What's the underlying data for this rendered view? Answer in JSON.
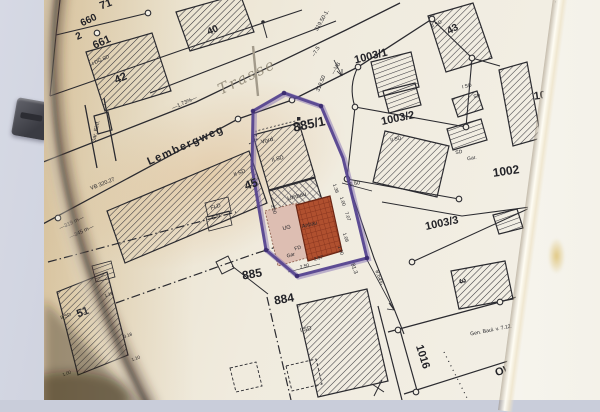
{
  "map": {
    "accent_colors": {
      "annotation_purple": "#53418e",
      "anbau_red": "#b0502f",
      "anbau_pink": "#ddbeb2",
      "paper_tan": "#e9dcc0",
      "pencil_grey": "#98907e"
    },
    "labels": [
      {
        "name": "parcel-label-71",
        "text": "71",
        "x": 106,
        "y": 5,
        "rot": -20,
        "size": 11,
        "w": 700
      },
      {
        "name": "parcel-label-660",
        "text": "660",
        "x": 89,
        "y": 21,
        "rot": -25,
        "size": 10,
        "w": 700
      },
      {
        "name": "parcel-label-660-denominator",
        "text": "2",
        "x": 79,
        "y": 37,
        "rot": -25,
        "size": 10,
        "w": 700
      },
      {
        "name": "parcel-label-661",
        "text": "661",
        "x": 102,
        "y": 43,
        "rot": -24,
        "size": 11,
        "w": 700
      },
      {
        "name": "building-label-42",
        "text": "42",
        "x": 121,
        "y": 79,
        "rot": -24,
        "size": 11,
        "w": 700
      },
      {
        "name": "building-label-40",
        "text": "40",
        "x": 213,
        "y": 31,
        "rot": -24,
        "size": 10,
        "w": 700
      },
      {
        "name": "building-label-43",
        "text": "43",
        "x": 453,
        "y": 30,
        "rot": -28,
        "size": 10,
        "w": 700
      },
      {
        "name": "parcel-label-885-1",
        "text": "885/1",
        "x": 309,
        "y": 124,
        "rot": -12,
        "size": 13,
        "w": 700
      },
      {
        "name": "parcel-label-1003-1",
        "text": "1003/1",
        "x": 371,
        "y": 57,
        "rot": -14,
        "size": 11,
        "w": 700
      },
      {
        "name": "parcel-label-1003-2",
        "text": "1003/2",
        "x": 398,
        "y": 119,
        "rot": -12,
        "size": 11,
        "w": 700
      },
      {
        "name": "parcel-label-1003-3",
        "text": "1003/3",
        "x": 442,
        "y": 224,
        "rot": -12,
        "size": 11,
        "w": 700
      },
      {
        "name": "parcel-label-1002",
        "text": "1002",
        "x": 506,
        "y": 171,
        "rot": -8,
        "size": 12,
        "w": 700
      },
      {
        "name": "parcel-label-100-partial",
        "text": "100",
        "x": 543,
        "y": 96,
        "rot": -8,
        "size": 11,
        "w": 700
      },
      {
        "name": "parcel-label-885",
        "text": "885",
        "x": 252,
        "y": 274,
        "rot": -10,
        "size": 12,
        "w": 700
      },
      {
        "name": "parcel-label-884",
        "text": "884",
        "x": 284,
        "y": 299,
        "rot": -10,
        "size": 12,
        "w": 700
      },
      {
        "name": "parcel-label-1016",
        "text": "1016",
        "x": 422,
        "y": 357,
        "rot": 72,
        "size": 11,
        "w": 700
      },
      {
        "name": "street-label-ow-63",
        "text": "OW 63",
        "x": 512,
        "y": 369,
        "rot": -16,
        "size": 11,
        "w": 700
      },
      {
        "name": "building-label-45",
        "text": "45",
        "x": 251,
        "y": 184,
        "rot": -20,
        "size": 12,
        "w": 700
      },
      {
        "name": "building-label-51",
        "text": "51",
        "x": 83,
        "y": 313,
        "rot": -20,
        "size": 11,
        "w": 700
      },
      {
        "name": "building-label-3",
        "text": "3",
        "x": 462,
        "y": 281,
        "rot": 80,
        "size": 9,
        "w": 700
      },
      {
        "name": "street-label-lembergweg",
        "text": "Lembergweg",
        "x": 186,
        "y": 146,
        "rot": -24,
        "size": 11,
        "w": 700,
        "ls": 1.5
      },
      {
        "name": "pencil-label-trasse",
        "text": "Trasse",
        "x": 247,
        "y": 77,
        "rot": -26,
        "size": 15,
        "cls": "pencil"
      },
      {
        "name": "grade-label",
        "text": "—1.73%—",
        "x": 185,
        "y": 104,
        "rot": -24,
        "size": 5.5
      },
      {
        "name": "level-label-320-27",
        "text": "VB 320.27",
        "x": 103,
        "y": 185,
        "rot": -22,
        "size": 5.5
      },
      {
        "name": "distance-label-319m",
        "text": "—319 m—",
        "x": 72,
        "y": 224,
        "rot": -25,
        "size": 5.5
      },
      {
        "name": "distance-label-345m",
        "text": "—345 m—",
        "x": 82,
        "y": 233,
        "rot": -25,
        "size": 5.5
      },
      {
        "name": "level-label-319-50-1",
        "text": "319.50-1.",
        "x": 323,
        "y": 21,
        "rot": -60,
        "size": 5.5
      },
      {
        "name": "level-label-7-5",
        "text": "–7.5",
        "x": 317,
        "y": 52,
        "rot": -60,
        "size": 5.5
      },
      {
        "name": "vb-label",
        "text": "—VB",
        "x": 337,
        "y": 69,
        "rot": -60,
        "size": 5.5
      },
      {
        "name": "level-label-319-50",
        "text": "319.50",
        "x": 322,
        "y": 84,
        "rot": -68,
        "size": 5.5
      },
      {
        "name": "garage-entrance-label",
        "text": "Gar. Einf.",
        "x": 97,
        "y": 132,
        "rot": -78,
        "size": 5.5
      },
      {
        "name": "vord-label",
        "text": "Vord.",
        "x": 268,
        "y": 141,
        "rot": -15,
        "size": 6
      },
      {
        "name": "storey-label-ii-sd-45",
        "text": "II SD",
        "x": 240,
        "y": 174,
        "rot": -20,
        "size": 5.5
      },
      {
        "name": "fld-label",
        "text": "FLD",
        "x": 216,
        "y": 208,
        "rot": -18,
        "size": 5.5
      },
      {
        "name": "garage-label-45",
        "text": "Gar.",
        "x": 217,
        "y": 218,
        "rot": -18,
        "size": 5.5
      },
      {
        "name": "storey-label-ii-sd-strip",
        "text": "II SD",
        "x": 278,
        "y": 160,
        "rot": -15,
        "size": 5.5
      },
      {
        "name": "umbau-label",
        "text": "Umbau",
        "x": 297,
        "y": 197,
        "rot": -16,
        "size": 6
      },
      {
        "name": "ug-label",
        "text": "UG",
        "x": 287,
        "y": 229,
        "rot": -15,
        "size": 5.5
      },
      {
        "name": "anbau-label",
        "text": "Anbau",
        "x": 310,
        "y": 226,
        "rot": -15,
        "size": 5.5
      },
      {
        "name": "fd-label",
        "text": "FD",
        "x": 298,
        "y": 249,
        "rot": -15,
        "size": 5
      },
      {
        "name": "garage-label-strip",
        "text": "Gar",
        "x": 291,
        "y": 256,
        "rot": -15,
        "size": 5
      },
      {
        "name": "dim-2-50-left",
        "text": "2.50",
        "x": 272,
        "y": 210,
        "rot": 72,
        "size": 4.8
      },
      {
        "name": "dim-2-50-bottom",
        "text": "2.50",
        "x": 305,
        "y": 268,
        "rot": -15,
        "size": 4.8
      },
      {
        "name": "dim-2-97",
        "text": "2.97",
        "x": 319,
        "y": 260,
        "rot": -15,
        "size": 4.8
      },
      {
        "name": "dim-1-38",
        "text": "1.38",
        "x": 334,
        "y": 189,
        "rot": 72,
        "size": 4.8
      },
      {
        "name": "dim-1-00-a",
        "text": "1.00",
        "x": 341,
        "y": 202,
        "rot": 72,
        "size": 4.8
      },
      {
        "name": "dim-7-07",
        "text": "7.07",
        "x": 346,
        "y": 217,
        "rot": 72,
        "size": 4.8
      },
      {
        "name": "dim-1-08",
        "text": "1.08",
        "x": 344,
        "y": 238,
        "rot": 72,
        "size": 4.8
      },
      {
        "name": "dim-1-00-b",
        "text": "1.00",
        "x": 339,
        "y": 251,
        "rot": 72,
        "size": 4.8
      },
      {
        "name": "dim-6-50",
        "text": "6.50",
        "x": 355,
        "y": 185,
        "rot": -14,
        "size": 5.5
      },
      {
        "name": "dim-81-3",
        "text": "81.3",
        "x": 353,
        "y": 269,
        "rot": 72,
        "size": 5.5
      },
      {
        "name": "dim-8-64",
        "text": "8.64¾",
        "x": 378,
        "y": 278,
        "rot": 72,
        "size": 5.5
      },
      {
        "name": "storey-label-i-dg-sd",
        "text": "I DG SD",
        "x": 101,
        "y": 61,
        "rot": -24,
        "size": 5
      },
      {
        "name": "storey-label-ii-sd-43",
        "text": "II SD",
        "x": 437,
        "y": 25,
        "rot": -28,
        "size": 5
      },
      {
        "name": "storey-label-ii-sd-51",
        "text": "II SD",
        "x": 66,
        "y": 317,
        "rot": -20,
        "size": 5
      },
      {
        "name": "storey-label-i-sd-884",
        "text": "I SD",
        "x": 306,
        "y": 330,
        "rot": -12,
        "size": 6
      },
      {
        "name": "storey-label-ii-sd-1003-2",
        "text": "II SD",
        "x": 396,
        "y": 140,
        "rot": -12,
        "size": 5
      },
      {
        "name": "storey-label-i-sd-1002",
        "text": "I SD",
        "x": 467,
        "y": 87,
        "rot": -12,
        "size": 5
      },
      {
        "name": "storey-label-sd-1002a",
        "text": "SD",
        "x": 477,
        "y": 97,
        "rot": -12,
        "size": 5
      },
      {
        "name": "storey-label-sd-1002b",
        "text": "SD",
        "x": 459,
        "y": 153,
        "rot": -10,
        "size": 5
      },
      {
        "name": "garage-label-1002",
        "text": "Gar.",
        "x": 472,
        "y": 159,
        "rot": -10,
        "size": 5
      },
      {
        "name": "approval-note",
        "text": "Gen. Baul. v. 7.12.1954",
        "x": 497,
        "y": 330,
        "rot": -11,
        "size": 5.2
      },
      {
        "name": "dim-1-18",
        "text": "1.18",
        "x": 109,
        "y": 295,
        "rot": -20,
        "size": 4.5
      },
      {
        "name": "dim-3-18",
        "text": "3.18",
        "x": 128,
        "y": 336,
        "rot": -20,
        "size": 4.5
      },
      {
        "name": "dim-1-00-c",
        "text": "1.00",
        "x": 67,
        "y": 374,
        "rot": -20,
        "size": 4.5
      },
      {
        "name": "dim-1-10",
        "text": "1.10",
        "x": 136,
        "y": 359,
        "rot": -20,
        "size": 4.5
      }
    ]
  },
  "right_page": {
    "items": [
      {
        "text": "8.6",
        "y": 10
      },
      {
        "text": "8.7",
        "y": 29
      },
      {
        "text": "8.8",
        "y": 45
      },
      {
        "text": "9",
        "y": 61
      },
      {
        "text": "9.1",
        "y": 79
      },
      {
        "text": "9.1.1",
        "y": 96
      },
      {
        "text": "9.1.2",
        "y": 114
      },
      {
        "text": "9.1.3",
        "y": 130
      },
      {
        "text": "9.1.4",
        "y": 147
      },
      {
        "text": "9.2",
        "y": 165
      },
      {
        "text": "9.3",
        "y": 215
      },
      {
        "text": "9.4.1",
        "y": 235
      },
      {
        "text": "9.4.2",
        "y": 253
      },
      {
        "text": "9.5.1",
        "y": 270
      },
      {
        "text": "9.5.2",
        "y": 289
      },
      {
        "text": "9.6",
        "y": 305
      },
      {
        "text": "9.7",
        "y": 322
      },
      {
        "text": "9.8",
        "y": 344
      },
      {
        "text": "9.9",
        "y": 355
      },
      {
        "text": "9.10",
        "y": 379
      },
      {
        "text": "9.11",
        "y": 394
      }
    ],
    "fragments": [
      {
        "text": "B",
        "y": 61
      },
      {
        "text": "z",
        "y": 96
      },
      {
        "text": "c",
        "y": 114
      },
      {
        "text": "c",
        "y": 130
      },
      {
        "text": "d",
        "y": 147
      },
      {
        "text": "b",
        "y": 209
      },
      {
        "text": "c",
        "y": 218
      },
      {
        "text": "b",
        "y": 231
      },
      {
        "text": "C",
        "y": 268
      }
    ]
  }
}
